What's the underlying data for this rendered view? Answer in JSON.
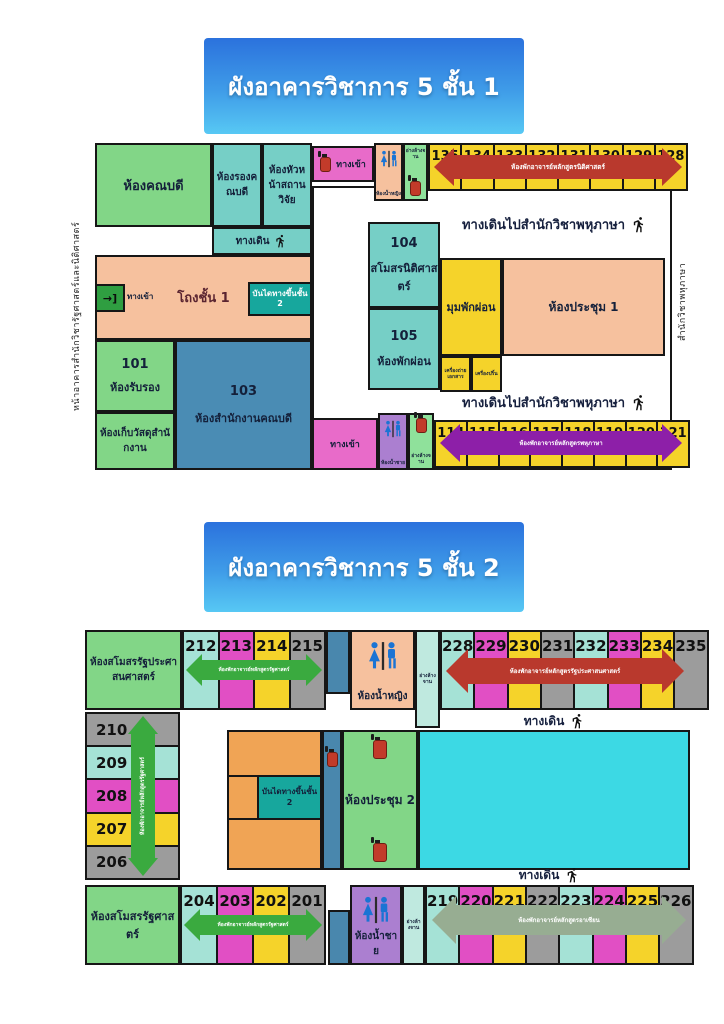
{
  "floor1": {
    "title": "ผังอาคารวิชาการ 5 ชั้น 1",
    "left_edge_label": "หน้าอาคารสำนักวิชารัฐศาสตร์และนิติศาสตร์",
    "right_edge_label": "สำนักวิชาพหุภาษา",
    "corridor_note": "ทางเดินไปสำนักวิชาพหุภาษา",
    "rooms": {
      "dean": "ห้องคณบดี",
      "deputy_dean": "ห้องรองคณบดี",
      "research_head": "ห้องหัวหน้าสถานวิจัย",
      "walkway": "ทางเดิน",
      "entrance": "ทางเข้า",
      "hall": "โถงชั้น 1",
      "hall_entrance_glyph": "→]",
      "stairs": "บันไดทางขึ้นชั้น2",
      "num101": "101",
      "reception": "ห้องรับรอง",
      "storage": "ห้องเก็บวัสดุสำนักงาน",
      "num103": "103",
      "dean_office": "ห้องสำนักงานคณบดี",
      "num104": "104",
      "law_club": "สโมสรนิติศาสตร์",
      "num105": "105",
      "rest_room": "ห้องพักผ่อน",
      "rest_corner": "มุมพักผ่อน",
      "copier": "เครื่องถ่ายเอกสาร",
      "printer": "เครื่องปริ้น",
      "meeting1": "ห้องประชุม 1",
      "wc_women": "ห้องน้ำหญิง",
      "wc_men": "ห้องน้ำชาย",
      "sink": "อ่างล้างจาน"
    },
    "row_top": {
      "cells": [
        "135",
        "134",
        "133",
        "132",
        "131",
        "130",
        "129",
        "128"
      ],
      "arrow_label": "ห้องพักอาจารย์หลักสูตรนิติศาสตร์"
    },
    "row_bottom": {
      "cells": [
        "114",
        "115",
        "116",
        "117",
        "118",
        "119",
        "120",
        "121"
      ],
      "arrow_label": "ห้องพักอาจารย์หลักสูตรพหุภาษา"
    },
    "cell_colors": [
      "#f5d32a"
    ]
  },
  "floor2": {
    "title": "ผังอาคารวิชาการ 5 ชั้น 2",
    "club_pa": "ห้องสโมสรรัฐประศาสนศาสตร์",
    "club_ps": "ห้องสโมสรรัฐศาสตร์",
    "wc_women": "ห้องน้ำหญิง",
    "wc_men": "ห้องน้ำชาย",
    "sink": "อ่างล้างจาน",
    "stairs": "บันไดทางขึ้นชั้น2",
    "meeting2": "ห้องประชุม 2",
    "walk_note": "ทางเดิน",
    "row_212": {
      "cells": [
        "212",
        "213",
        "214",
        "215"
      ],
      "arrow_label": "ห้องพักอาจารย์หลักสูตรรัฐศาสตร์"
    },
    "row_228": {
      "cells": [
        "228",
        "229",
        "230",
        "231",
        "232",
        "233",
        "234",
        "235"
      ],
      "arrow_label": "ห้องพักอาจารย์หลักสูตรรัฐประศาสนศาสตร์"
    },
    "col_left": {
      "cells": [
        "210",
        "209",
        "208",
        "207",
        "206"
      ],
      "arrow_label": "ห้องพักอาจารย์หลักสูตรรัฐศาสตร์"
    },
    "row_204": {
      "cells": [
        "204",
        "203",
        "202",
        "201"
      ],
      "arrow_label": "ห้องพักอาจารย์หลักสูตรรัฐศาสตร์"
    },
    "row_219": {
      "cells": [
        "219",
        "220",
        "221",
        "222",
        "223",
        "224",
        "225",
        "226"
      ],
      "arrow_label": "ห้องพักอาจารย์หลักสูตรอาเซียน"
    },
    "cell_colors": [
      "#a5e2d6",
      "#e14fc4",
      "#f5d32a",
      "#9c9c9c"
    ],
    "left_col_colors": [
      "#9c9c9c",
      "#a5e2d6",
      "#e14fc4",
      "#f5d32a"
    ]
  },
  "colors": {
    "arrow_red": "#b9392d",
    "arrow_purple": "#8d1fa8",
    "arrow_green": "#3aaa3f",
    "arrow_sage": "#97ad92",
    "room_green": "#82d687",
    "room_teal": "#76cfc6",
    "room_salmon": "#f6c19e",
    "room_yellow": "#f5d32a",
    "room_blue": "#4a8cb4",
    "room_pink": "#e86bc9",
    "room_purple": "#ab7fd0",
    "room_orange": "#f0a455",
    "room_cyan_big": "#3cd9e4"
  }
}
